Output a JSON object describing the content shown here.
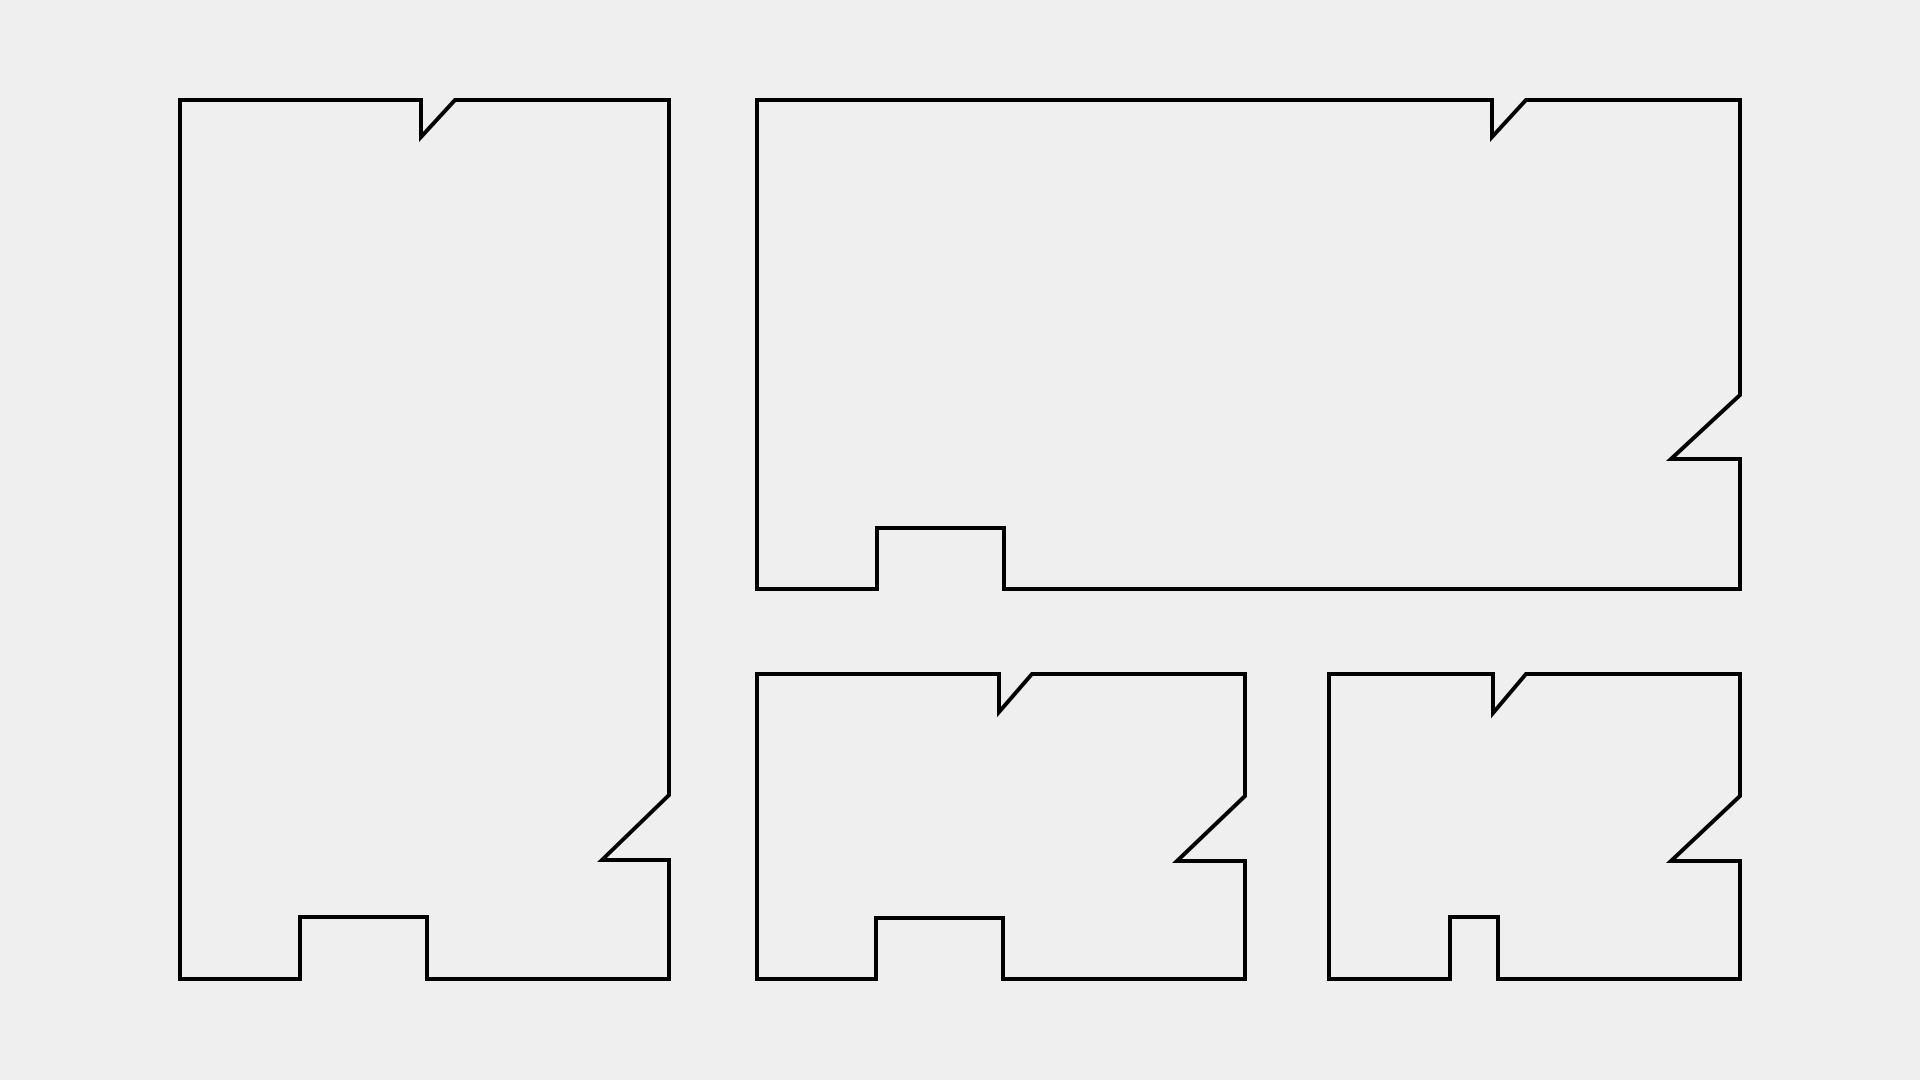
{
  "page": {
    "background_color": "#efefef"
  },
  "drawing": {
    "description": "cut-layout of four notched rectangular panels",
    "canvas_width": 1920,
    "canvas_height": 1080,
    "stroke_color": "#000000",
    "stroke_width": 4,
    "shapes": [
      {
        "name": "panel-outline-tall-left",
        "points": [
          [
            180,
            100
          ],
          [
            421,
            100
          ],
          [
            421,
            137
          ],
          [
            455,
            100
          ],
          [
            669,
            100
          ],
          [
            669,
            795
          ],
          [
            602,
            860
          ],
          [
            669,
            860
          ],
          [
            669,
            979
          ],
          [
            427,
            979
          ],
          [
            427,
            917
          ],
          [
            300,
            917
          ],
          [
            300,
            979
          ],
          [
            180,
            979
          ]
        ]
      },
      {
        "name": "panel-outline-wide-top-right",
        "points": [
          [
            757,
            100
          ],
          [
            1492,
            100
          ],
          [
            1492,
            137
          ],
          [
            1526,
            100
          ],
          [
            1740,
            100
          ],
          [
            1740,
            395
          ],
          [
            1671,
            459
          ],
          [
            1740,
            459
          ],
          [
            1740,
            589
          ],
          [
            1004,
            589
          ],
          [
            1004,
            528
          ],
          [
            877,
            528
          ],
          [
            877,
            589
          ],
          [
            757,
            589
          ]
        ]
      },
      {
        "name": "panel-outline-bottom-middle",
        "points": [
          [
            757,
            674
          ],
          [
            999,
            674
          ],
          [
            999,
            712
          ],
          [
            1032,
            674
          ],
          [
            1245,
            674
          ],
          [
            1245,
            796
          ],
          [
            1177,
            861
          ],
          [
            1245,
            861
          ],
          [
            1245,
            979
          ],
          [
            1003,
            979
          ],
          [
            1003,
            918
          ],
          [
            876,
            918
          ],
          [
            876,
            979
          ],
          [
            757,
            979
          ]
        ]
      },
      {
        "name": "panel-outline-bottom-right",
        "points": [
          [
            1329,
            674
          ],
          [
            1493,
            674
          ],
          [
            1493,
            713
          ],
          [
            1526,
            674
          ],
          [
            1740,
            674
          ],
          [
            1740,
            796
          ],
          [
            1671,
            861
          ],
          [
            1740,
            861
          ],
          [
            1740,
            979
          ],
          [
            1498,
            979
          ],
          [
            1498,
            917
          ],
          [
            1450,
            917
          ],
          [
            1450,
            979
          ],
          [
            1329,
            979
          ]
        ]
      }
    ]
  }
}
